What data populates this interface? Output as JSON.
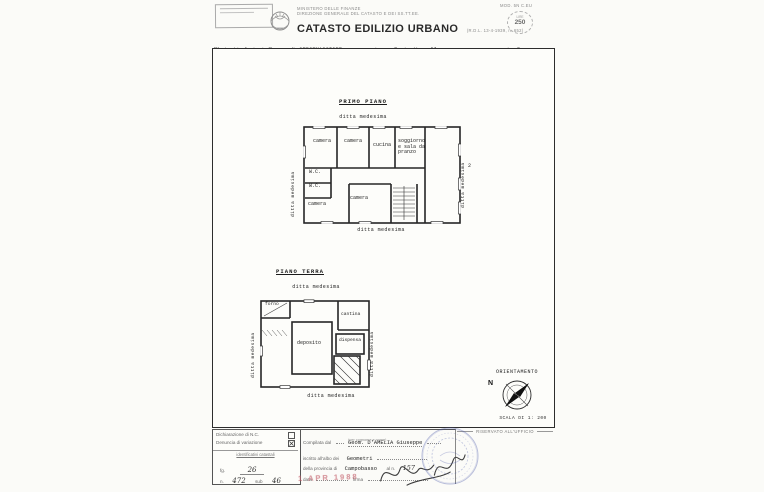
{
  "header": {
    "ministry_line1": "MINISTERO DELLE FINANZE",
    "ministry_line2": "DIREZIONE GENERALE DEL CATASTO E DEI SS.TT.EE.",
    "title": "CATASTO EDILIZIO URBANO",
    "title_ref": "(R.D.L. 13-4-1939, n. 652)",
    "mod_code": "MOD. 5N C.EU",
    "revenue_stamp": {
      "top": "LIRE",
      "value": "250"
    },
    "subtitle": {
      "prefix": "Planimetria di u.i.u. in Comune di",
      "comune": "CERCEMAGGIORE",
      "via_label": "via",
      "via_value": "Fonte Varrella",
      "civ_label": "civ.",
      "civ_value": "R"
    }
  },
  "plans": {
    "primo_piano": {
      "title": "PRIMO PIANO",
      "boundary_top": "ditta medesima",
      "boundary_bottom": "ditta medesima",
      "boundary_left": "ditta medesima",
      "boundary_right": "ditta medesima",
      "mark_right": "2",
      "rooms": {
        "camera_1": "camera",
        "camera_2": "camera",
        "cucina": "cucina",
        "soggiorno": "soggiorno\ne sala da\npranzo",
        "wc_1": "W.C.",
        "wc_2": "W.C.",
        "camera_3": "camera",
        "camera_4": "camera"
      }
    },
    "piano_terra": {
      "title": "PIANO TERRA",
      "boundary_top": "ditta medesima",
      "boundary_bottom": "ditta medesima",
      "boundary_left": "ditta medesima",
      "boundary_right": "ditta medesima",
      "rooms": {
        "forno": "forno",
        "cantina": "cantina",
        "dispensa": "dispensa",
        "deposito": "deposito"
      }
    }
  },
  "orientation": {
    "title": "ORIENTAMENTO",
    "north": "N",
    "scale": "SCALA DI 1: 200"
  },
  "footer": {
    "declaration": {
      "row1": "Dichiarazione di N.C.",
      "row2": "Denuncia di variazione",
      "ids_title": "identificativi catastali",
      "fg_label": "fg.",
      "fg_value": "26",
      "n_label": "n.",
      "n_value": "472",
      "sub_label": "sub",
      "sub_value": "46"
    },
    "compiler": {
      "label": "Compilata dal",
      "name": "Geom. D'AMELIA Giuseppe",
      "note": "(per cognome e nome)",
      "albo_label": "iscritto all'albo dei",
      "albo_value": "Geometri",
      "prov_label": "della provincia di",
      "prov_value": "Campobasso",
      "num_label": "al n.",
      "num_value": "157",
      "date_label": "data",
      "sign_label": "firma",
      "date_stamp": "1 APR 1988"
    },
    "office": {
      "title": "RISERVATO ALL'UFFICIO"
    }
  }
}
